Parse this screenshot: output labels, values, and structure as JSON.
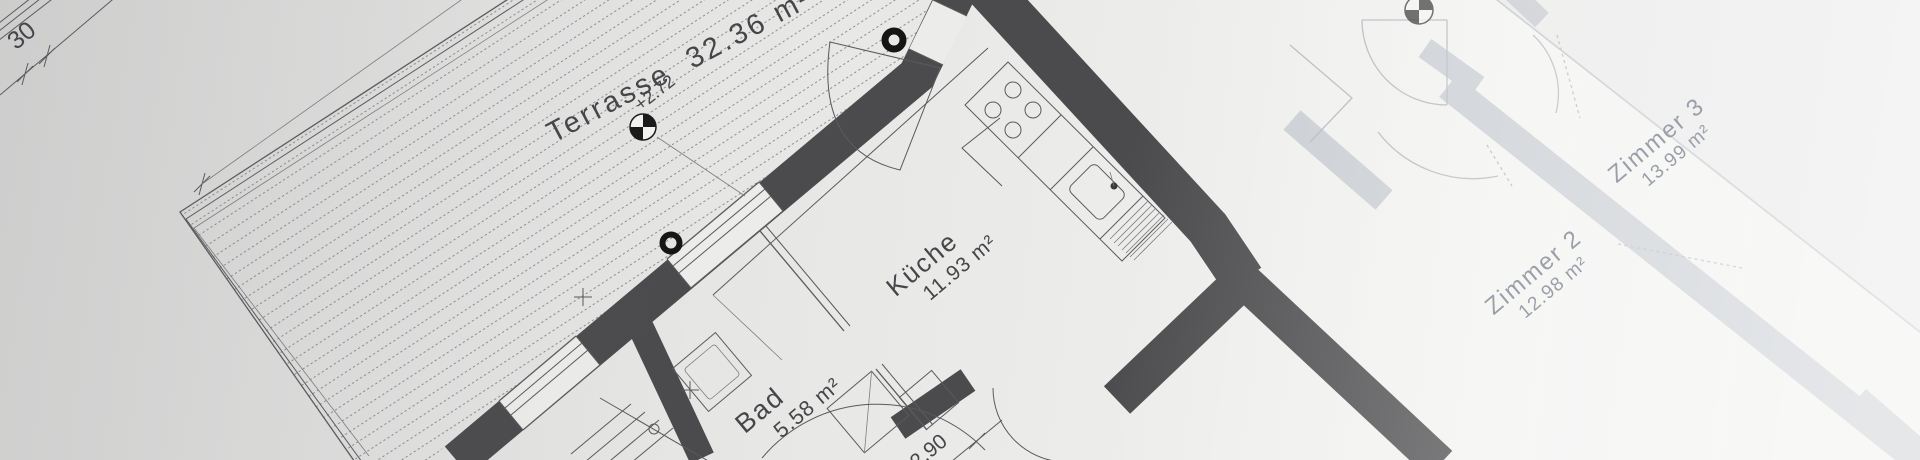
{
  "photo": {
    "description": "Architectural floor plan blueprint photographed at an angle"
  },
  "rooms": {
    "terrasse": {
      "name": "Terrasse",
      "area": "32.36 m²"
    },
    "kueche": {
      "name": "Küche",
      "area": "11.93 m²"
    },
    "bad": {
      "name": "Bad",
      "area": "5.58 m²"
    },
    "zimmer2": {
      "name": "Zimmer 2",
      "area": "12.98 m²"
    },
    "zimmer3": {
      "name": "Zimmer 3",
      "area": "13.99 m²"
    }
  },
  "marks": {
    "elevation": "+2.72",
    "dim_top_left": "30",
    "dim_bottom": "2.90"
  },
  "colors": {
    "paper": "#e7e7e6",
    "wall_dark": "#4b4b4d",
    "wall_light": "#c9cdd2",
    "line": "#5a5a5e",
    "line_light": "#b4b8bf",
    "label": "#46464a",
    "label_faded": "#9aa0a9",
    "hatch": "#8b8b8b"
  }
}
